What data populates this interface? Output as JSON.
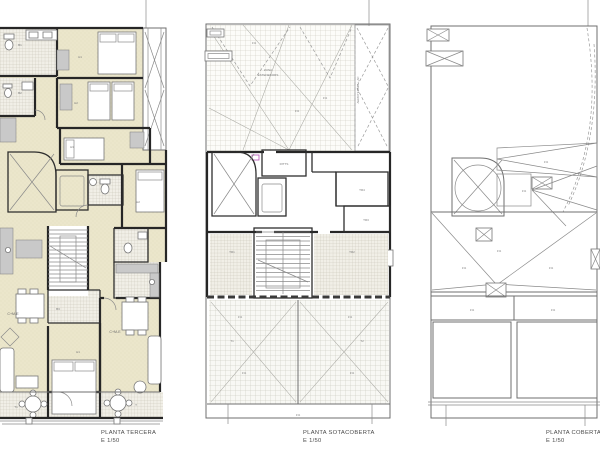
{
  "drawing": {
    "captions": {
      "tercera": {
        "title": "PLANTA TERCERA",
        "scale": "E 1/50"
      },
      "sotacoberta": {
        "title": "PLANTA SOTACOBERTA",
        "scale": "E 1/50"
      },
      "coberta": {
        "title": "PLANTA COBERTA",
        "scale": "E 1/50"
      }
    },
    "tercera": {
      "rooms": {
        "b1": "B1",
        "b2": "B2",
        "h1": "H1",
        "h2": "H2",
        "h3": "H3",
        "h2r": "H2",
        "b3": "B3",
        "cme_left": "C+M-E",
        "cme_right": "C+M-E",
        "h1b": "H1",
        "t1": "T1",
        "t": "T"
      }
    },
    "sotacoberta": {
      "labels": {
        "zona1": "ZONA",
        "zona2": "ESTENEDORS",
        "aero": "AEROTERMIA + AC",
        "ritts": "RITTS",
        "tr1": "TR1",
        "tr2": "TR2",
        "tr3": "TR3",
        "tr4": "TR4",
        "t1": "T1",
        "t2": "T2",
        "slope": "1%"
      }
    },
    "coberta": {
      "labels": {
        "slope": "1%"
      }
    },
    "colors": {
      "wall": "#262626",
      "thin_line": "#8a8a8a",
      "floor_beige": "#ebe6cb",
      "tile": "#f1efe7",
      "furniture_gray": "#c9c9c9",
      "accent_magenta": "#b14fb1"
    }
  }
}
